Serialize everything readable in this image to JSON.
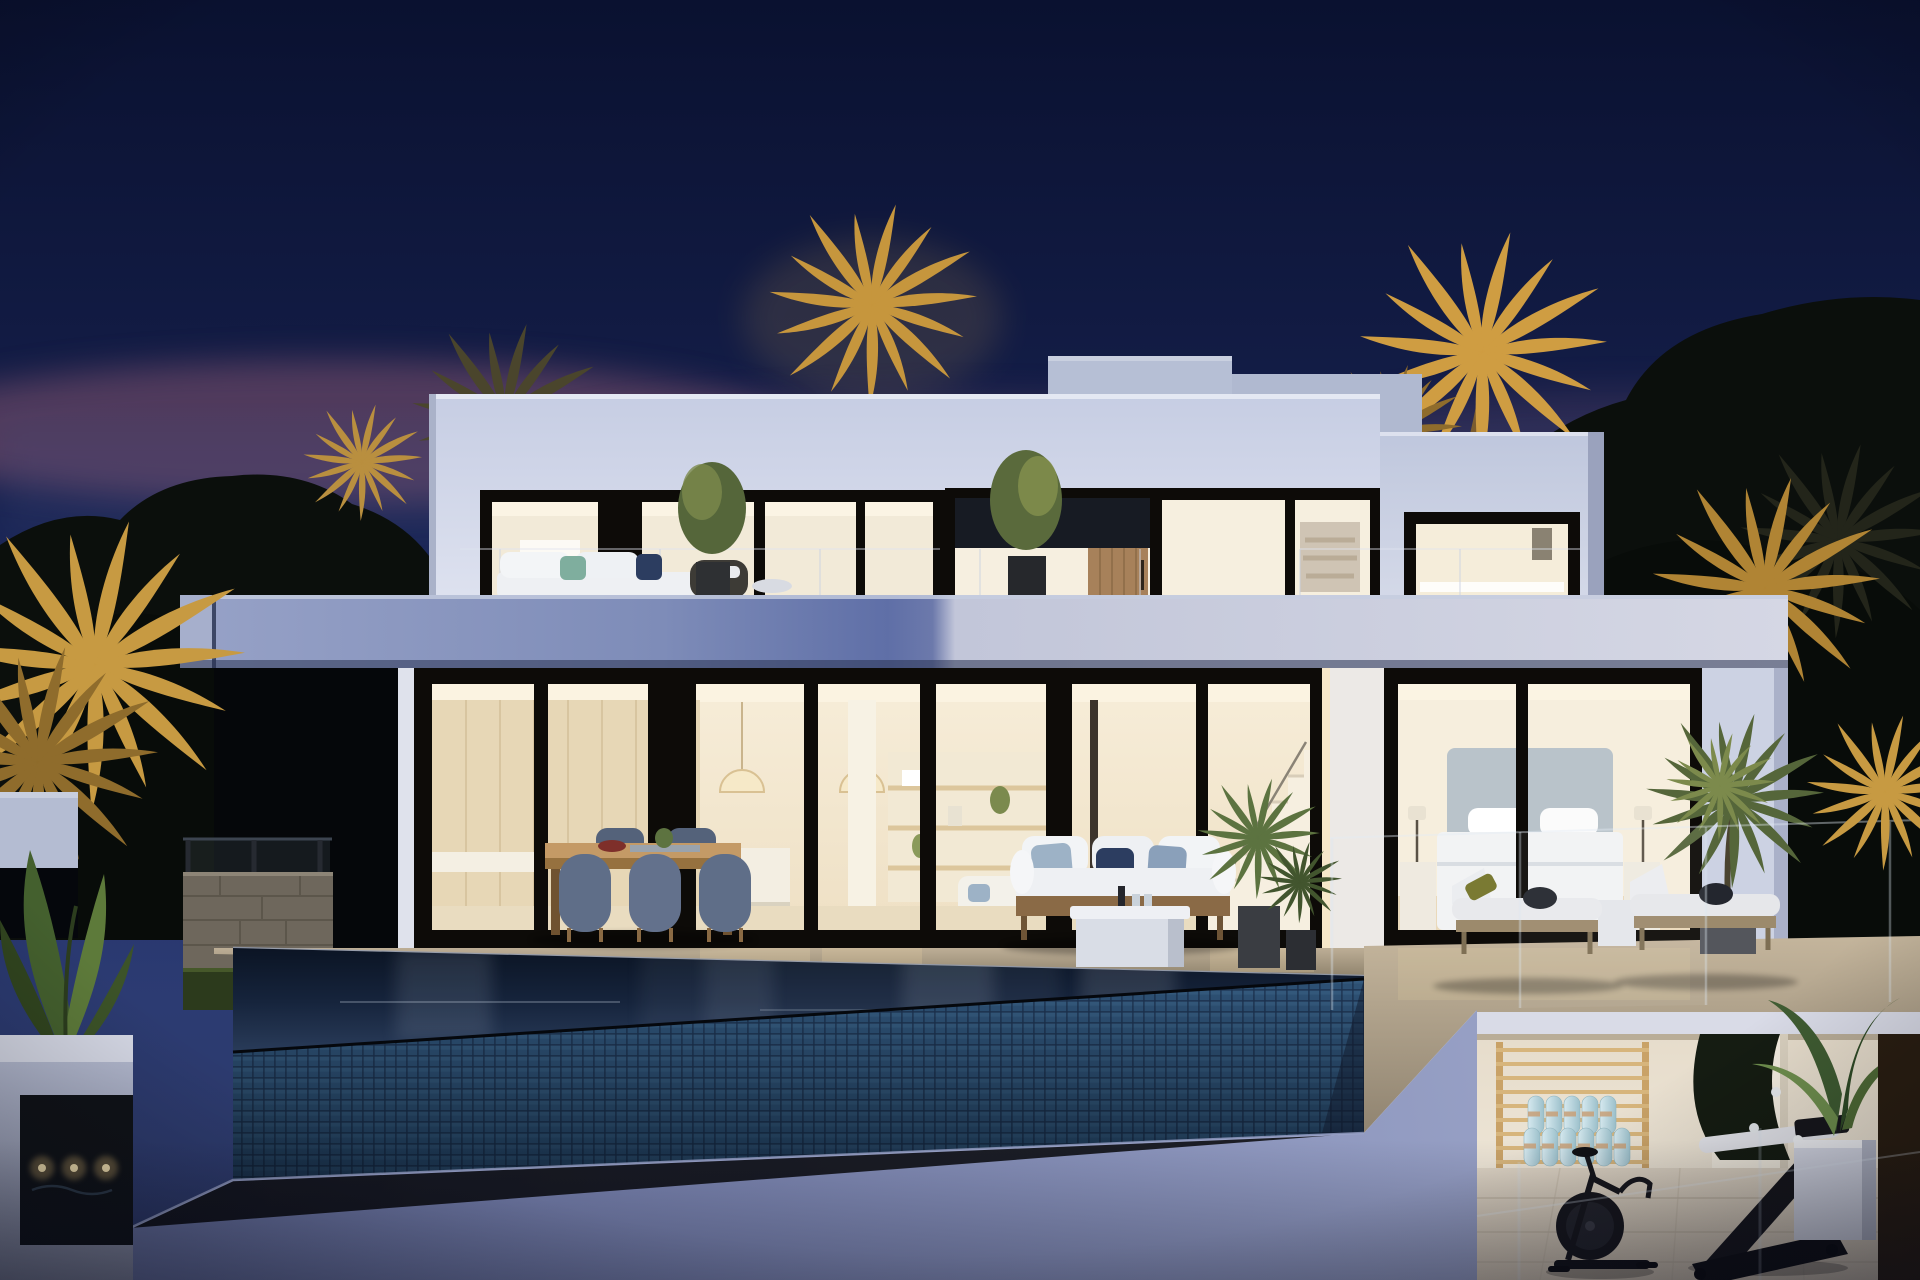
{
  "image": {
    "kind": "dusk architectural rendering of a modern two-storey villa with infinity pool",
    "width_px": 1920,
    "height_px": 1280
  },
  "palette": {
    "sky_top": "#0a1130",
    "sky_mid": "#141e49",
    "sky_low": "#2c3b72",
    "sunset_pink": "#8d5872",
    "tree_silhouette": "#0b0f0c",
    "palm_gold": "#c6963d",
    "palm_gold_deep": "#8f6c2c",
    "palm_olive": "#4a452c",
    "facade_light": "#cdd3e7",
    "facade_shade": "#b0b9d0",
    "slab_blue": "#5f6fa7",
    "slab_light": "#d3d5e3",
    "frame_black": "#0d0b08",
    "glass_warm": "#f5e9d2",
    "wood_interior": "#e7d7b6",
    "interior_white": "#f6efe0",
    "door_wood": "#a7815a",
    "deck_warm": "#bcae96",
    "deck_shadow": "#8a7e68",
    "pool_water": "#0a1322",
    "pool_tile": "#2f5479",
    "lower_wall": "#6f79a8",
    "gym_wall": "#efe7d8",
    "gym_floor": "#d8cec0",
    "mat_blue": "#bcdae3",
    "wall_bars_wood": "#c9a267",
    "equipment_black": "#17171c",
    "planter_white": "#d6d9e6",
    "leaf_green": "#55663a",
    "leaf_lit": "#7c8a4c",
    "cushion_white": "#eef0f3",
    "pillow_navy": "#2c3d60",
    "pillow_blue": "#9db2c6",
    "stone_wall": "#6e675c",
    "grass_dark": "#2c3a1c",
    "jet_glow": "#e8c27a"
  },
  "inventory": {
    "storeys_visible": 2,
    "sun_loungers": 2,
    "outdoor_dining_chairs_visible": 5,
    "pendant_lamps_visible": 2,
    "rolled_exercise_mats": 11,
    "spa_jets_lit": 3,
    "gold_lit_palm_clusters": 6
  }
}
